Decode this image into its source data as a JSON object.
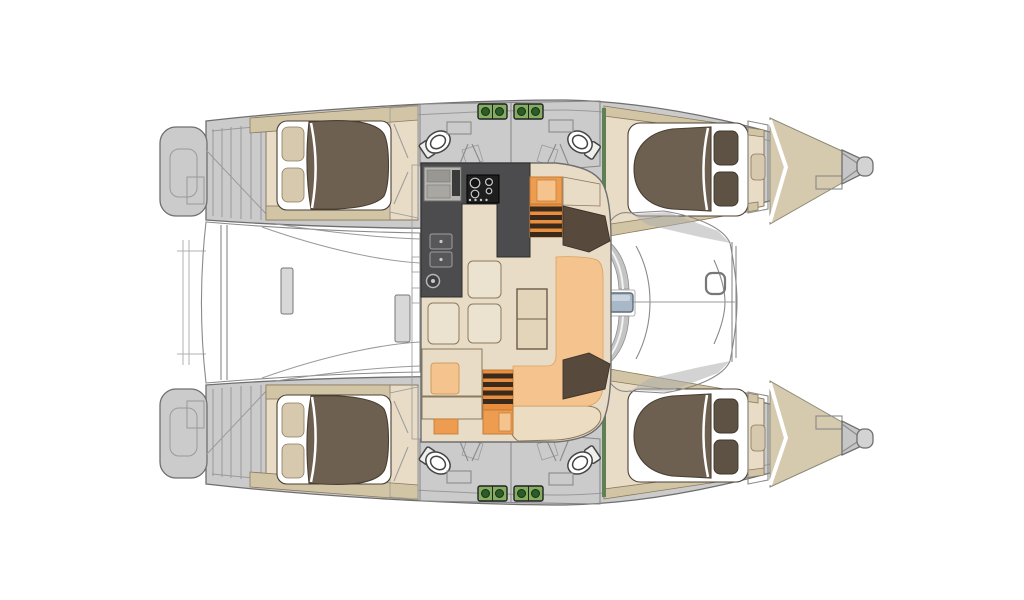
{
  "canvas": {
    "width": 1024,
    "height": 600,
    "background": "#ffffff"
  },
  "boat": {
    "type": "catamaran-floor-plan",
    "hulls": 2,
    "double_cabins": 4,
    "bathrooms": 4,
    "bow_crew_berths": 2,
    "toilets_visible": 4,
    "deck_hatches_visible": 4
  },
  "colors": {
    "hull_fill": "#cbcbcb",
    "hull_stroke": "#6f6f6f",
    "line_gray": "#9a9a9a",
    "cockpit_gray": "#c9c9c9",
    "cockpit_line": "#8a8a8a",
    "shade_gray": "#aeaeae",
    "support_gray": "#d8d8d8",
    "deck_beige": "#d2c5a5",
    "bow_deck": "#d5c9ae",
    "cabin_floor": "#e8dcc6",
    "trim": "#8a7a5e",
    "bed_brown": "#6e6050",
    "bed_stroke": "#4a3f33",
    "pillow_beige": "#d7c9ae",
    "pillow_brown": "#5e5245",
    "bath_white": "#fcfcfa",
    "fixture_stroke": "#444444",
    "shower_tray": "#efefec",
    "entry_white": "#f7f5f0",
    "hatch_green": "#84ad62",
    "hatch_dark": "#2e5b2a",
    "green_trim": "#5f7f55",
    "galley_dark": "#4c4c4e",
    "galley_stroke": "#2b2b2b",
    "stove_black": "#1e1e1e",
    "burner_ring": "#c9c9c9",
    "sink_gray": "#b7b5b0",
    "sink_inner1": "#999792",
    "sink_inner2": "#a9a7a2",
    "faucet_dark": "#3a3a3a",
    "bowl_gray": "#57575a",
    "salon_floor": "#e9dcc7",
    "salon_stroke": "#6f6f6f",
    "sofa_orange": "#f5c48e",
    "sofa_stroke": "#d9a160",
    "seat_orange": "#ee9c50",
    "seat_stroke": "#c07b35",
    "step_orange": "#e88e3e",
    "step_dark": "#3a2a1c",
    "cushion_beige": "#ece2d0",
    "table_beige": "#e3d5ba",
    "bench_beige": "#ecdcc2",
    "bench_blue": "#a9b8c6",
    "bench_blue_highlight": "#c9d4de",
    "bench_blue_stroke": "#5f6c78",
    "door_step": "#dedede",
    "dark_wood": "#57493c",
    "dark_wood_stroke": "#3c332a",
    "panel_light": "#efeeea",
    "crescent_gray": "#c4c4c4",
    "highlight": "#f3f3f3",
    "tip_gray": "#c6c6c6",
    "cap_gray": "#d3d3d3",
    "anchor_gray": "#c9c9c9",
    "hatch_light": "#d6d6d6",
    "white": "#ffffff"
  }
}
